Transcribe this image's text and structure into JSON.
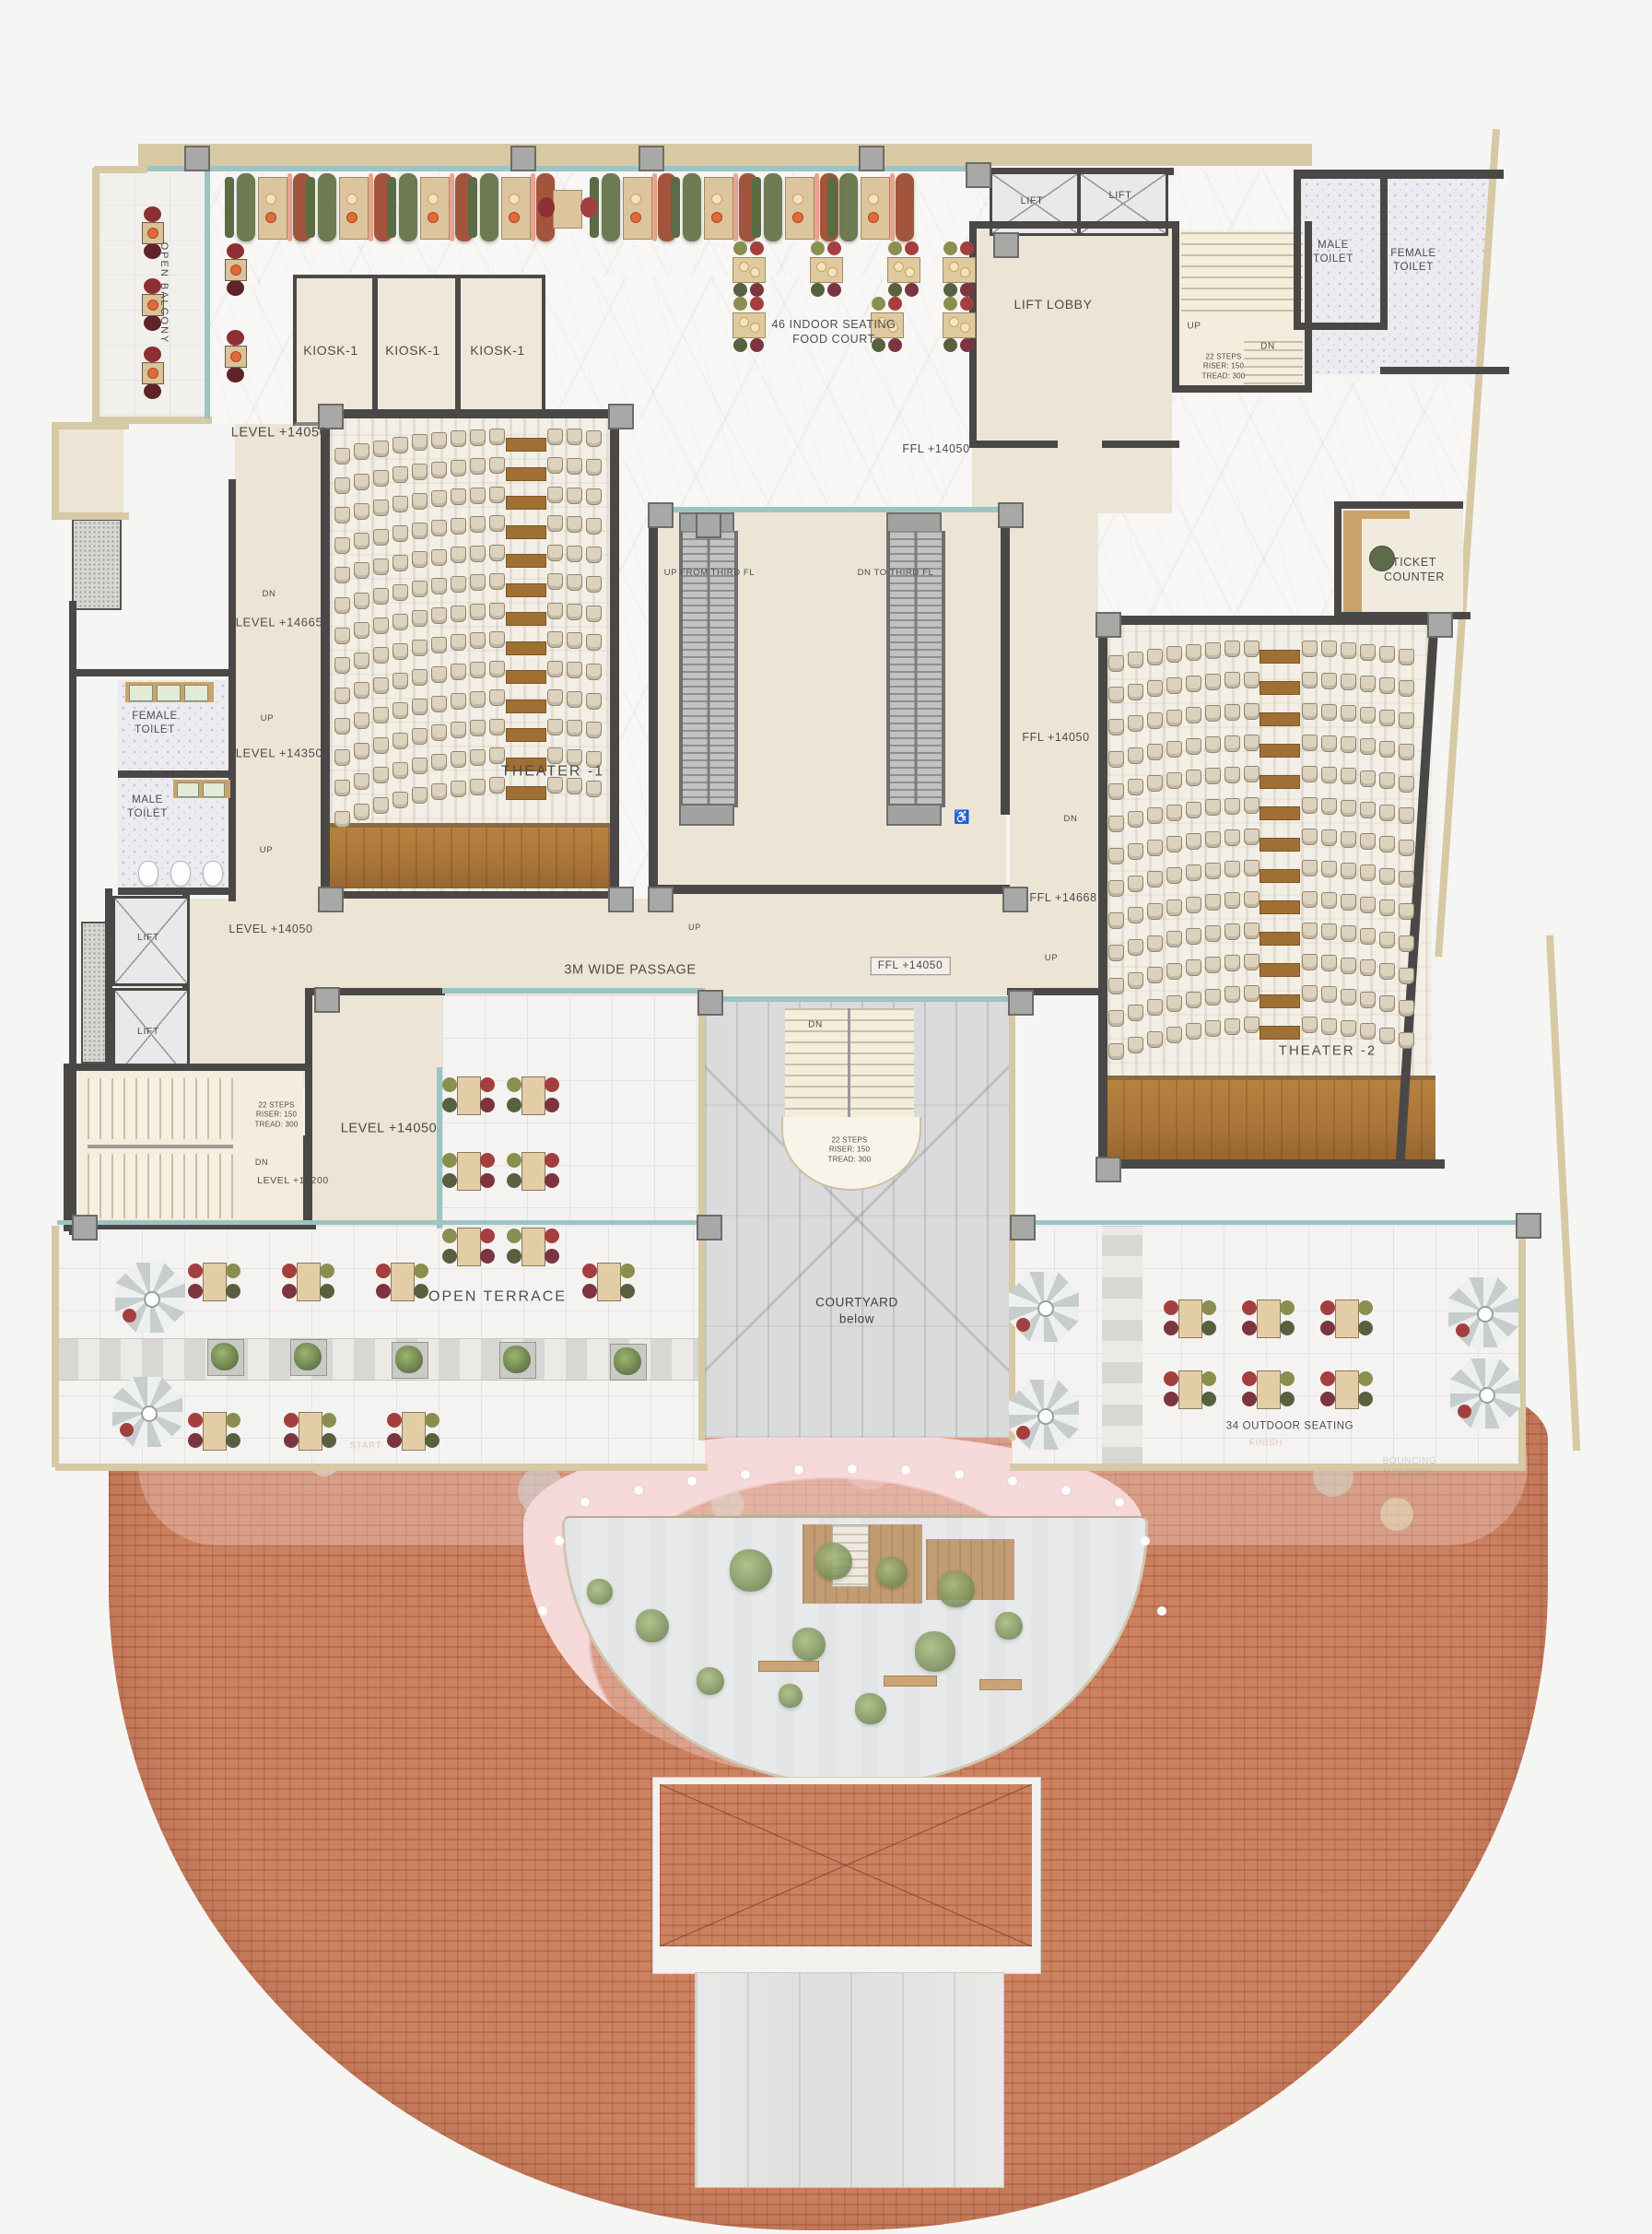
{
  "colors": {
    "wall_dark": "#4a4846",
    "glass_teal": "#9dc3c3",
    "boundary_tan": "#d6c9a4",
    "roof_tile": "#c67c5c",
    "stage_wood": "#b07c3e",
    "theater_seat": "#ddd2bd",
    "pink_walkway": "#f6d9d9",
    "courtyard_paver": "#dbdbdd"
  },
  "balcony": {
    "label": "OPEN BALCONY"
  },
  "kiosks": {
    "k1": "KIOSK-1",
    "k2": "KIOSK-1",
    "k3": "KIOSK-1"
  },
  "food_court": {
    "label": "46 INDOOR SEATING\nFOOD COURT"
  },
  "lifts": {
    "tr_1": "LIFT",
    "tr_2": "LIFT",
    "left_1": "LIFT",
    "left_2": "LIFT",
    "lobby_tr": "LIFT LOBBY",
    "lobby_left_level": "LEVEL +14050"
  },
  "stairs": {
    "tr": {
      "up": "UP",
      "dn": "DN",
      "note": "22 STEPS\nRISER: 150\nTREAD: 300"
    },
    "bl": {
      "dn": "DN",
      "note": "22 STEPS\nRISER: 150\nTREAD: 300",
      "level": "LEVEL +14200",
      "room_level": "LEVEL +14050"
    },
    "courtyard": {
      "dn": "DN",
      "note": "22 STEPS\nRISER: 150\nTREAD: 300"
    }
  },
  "toilets": {
    "male_tr": "MALE\nTOILET",
    "female_tr": "FEMALE\nTOILET",
    "female_left": "FEMALE\nTOILET",
    "male_left": "MALE\nTOILET"
  },
  "levels": {
    "top": "LEVEL +14050",
    "l14665": "LEVEL +14665",
    "l14350": "LEVEL +14350",
    "corridor_dn": "DN",
    "corridor_up_1": "UP",
    "corridor_up_2": "UP"
  },
  "ffl": {
    "lobby": "FFL +14050",
    "mid": "FFL +14050",
    "l14668": "FFL +14668",
    "passage_boxed": "FFL +14050",
    "corridor_r_dn": "DN",
    "corridor_r_up": "UP"
  },
  "theaters": {
    "t1": "THEATER -1",
    "t2": "THEATER -2"
  },
  "escalators": {
    "up": "UP FROM THIRD FL",
    "dn": "DN TO THIRD FL"
  },
  "ticket_counter": {
    "label": "TICKET\nCOUNTER"
  },
  "passage": {
    "label": "3M WIDE PASSAGE",
    "up": "UP"
  },
  "terrace": {
    "open_terrace": "OPEN TERRACE",
    "outdoor_seating": "34  OUTDOOR SEATING"
  },
  "courtyard": {
    "label": "COURTYARD\nbelow"
  },
  "play_area": {
    "start": "START",
    "finish": "FINISH",
    "bouncing": "BOUNCING\nMOUNTAIN"
  },
  "icons": {
    "wheelchair": "♿"
  }
}
